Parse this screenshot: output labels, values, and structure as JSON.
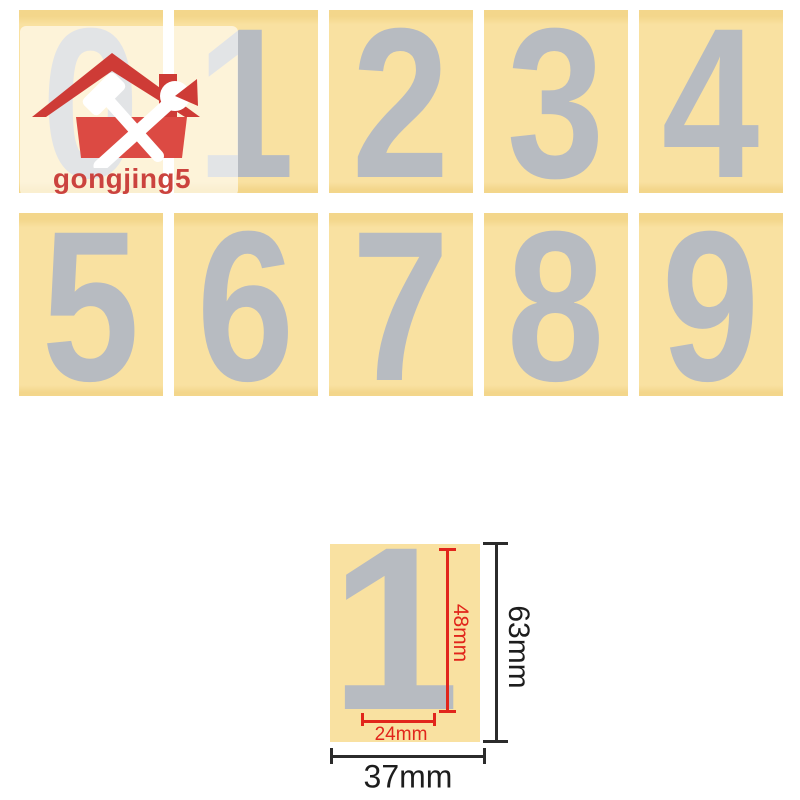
{
  "watermark": {
    "brand": "gongjing5"
  },
  "stickers": {
    "digits": [
      "0",
      "1",
      "2",
      "3",
      "4",
      "5",
      "6",
      "7",
      "8",
      "9"
    ]
  },
  "diagram": {
    "digit": "1",
    "digit_height": "48mm",
    "digit_width": "24mm",
    "card_height": "63mm",
    "card_width": "37mm"
  },
  "icons": {
    "logo": "house-with-hammer-and-wrench"
  },
  "colors": {
    "page_bg": "#ffffff",
    "card_face": "#f9e1a1",
    "card_edge": "#f3d68b",
    "digit_gray": "#b7bbc1",
    "logo_red_dark": "#ce3b36",
    "logo_red": "#dc4a43",
    "brand_red": "#cb433e",
    "dim_red": "#e1251b",
    "dim_black": "#2b2b2b",
    "dim_black_text": "#1d1d1d"
  }
}
